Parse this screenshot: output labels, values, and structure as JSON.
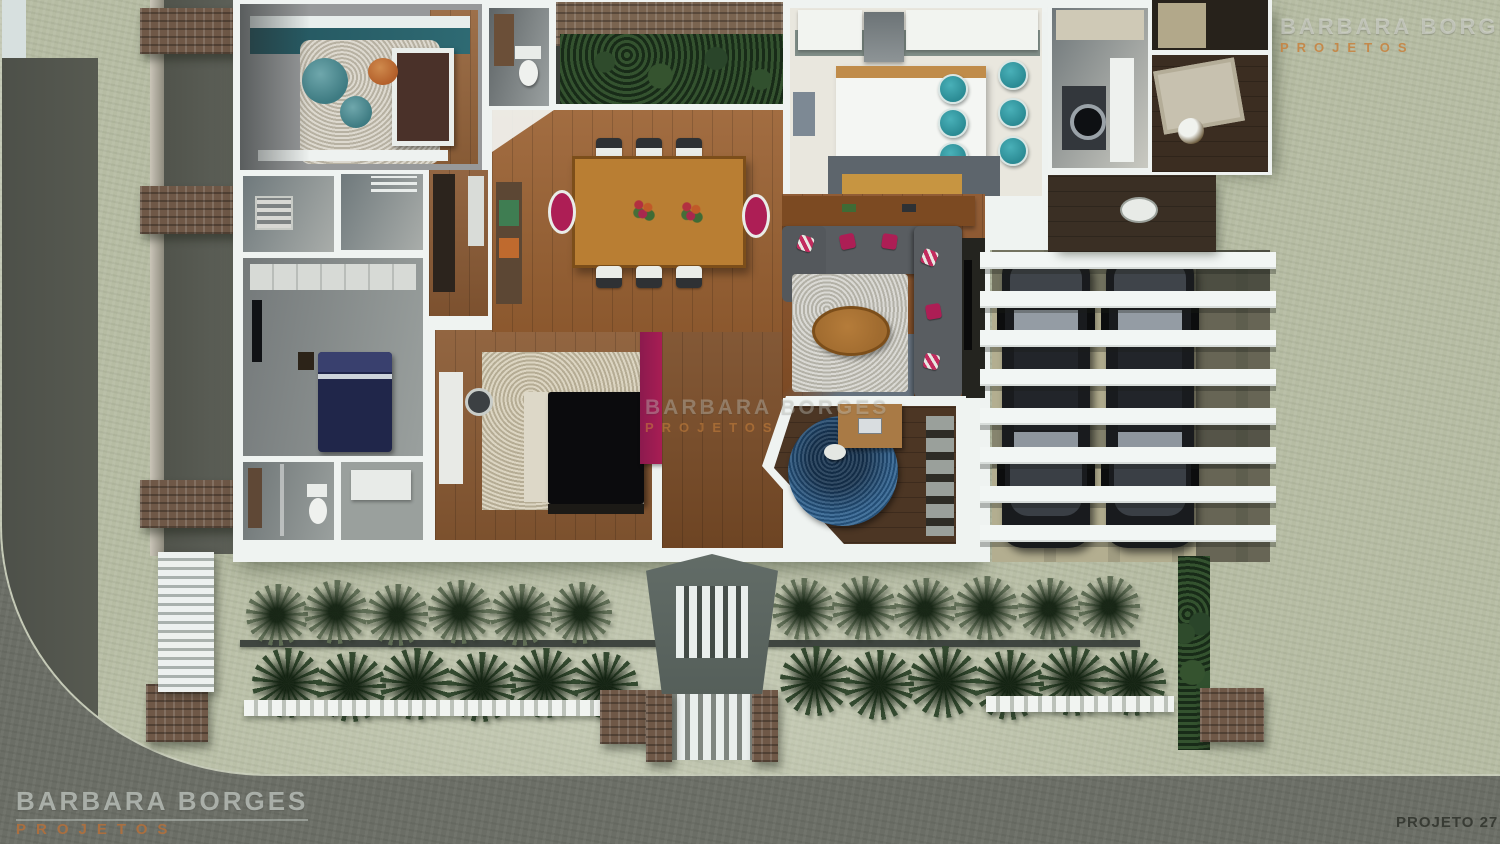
{
  "branding": {
    "studio_name": "BARBARA BORGES",
    "studio_subtitle": "PROJETOS",
    "project_label": "PROJETO 27"
  },
  "watermarks": {
    "top_right": {
      "line1": "BARBARA BORGES",
      "line2": "PROJETOS"
    },
    "center": {
      "line1": "BARBARA BORGES",
      "line2": "PROJETOS"
    },
    "bottom_left": {
      "line1": "BARBARA BORGES",
      "line2": "PROJETOS"
    },
    "bottom_right_label": "PROJETO 27"
  },
  "colors": {
    "lawn": "#b6bca3",
    "street": "#6b6e66",
    "shadow-dark": "#53564e",
    "wall-white": "#eff3f1",
    "wood": "#9b6233",
    "wood-dark": "#4c3624",
    "hall-wood": "#7a4c27",
    "teal": "#2b8b94",
    "teal-wall": "#2e6a73",
    "magenta": "#ad1e55",
    "navy": "#20264a",
    "rug-beige": "#cdc3a8",
    "rug-gray": "#cac9c1",
    "rug-blue": "#2b5e8c",
    "plant-light": "#5f6d55",
    "plant-dark": "#33492f",
    "brick": "#6f5847",
    "car-body": "#191b1e",
    "island-top": "#c08c4a",
    "counter-dark": "#5d656c",
    "orange-accent": "#c8813c",
    "watermark-gray": "#b8beb9",
    "project-label-color": "#383b34"
  }
}
